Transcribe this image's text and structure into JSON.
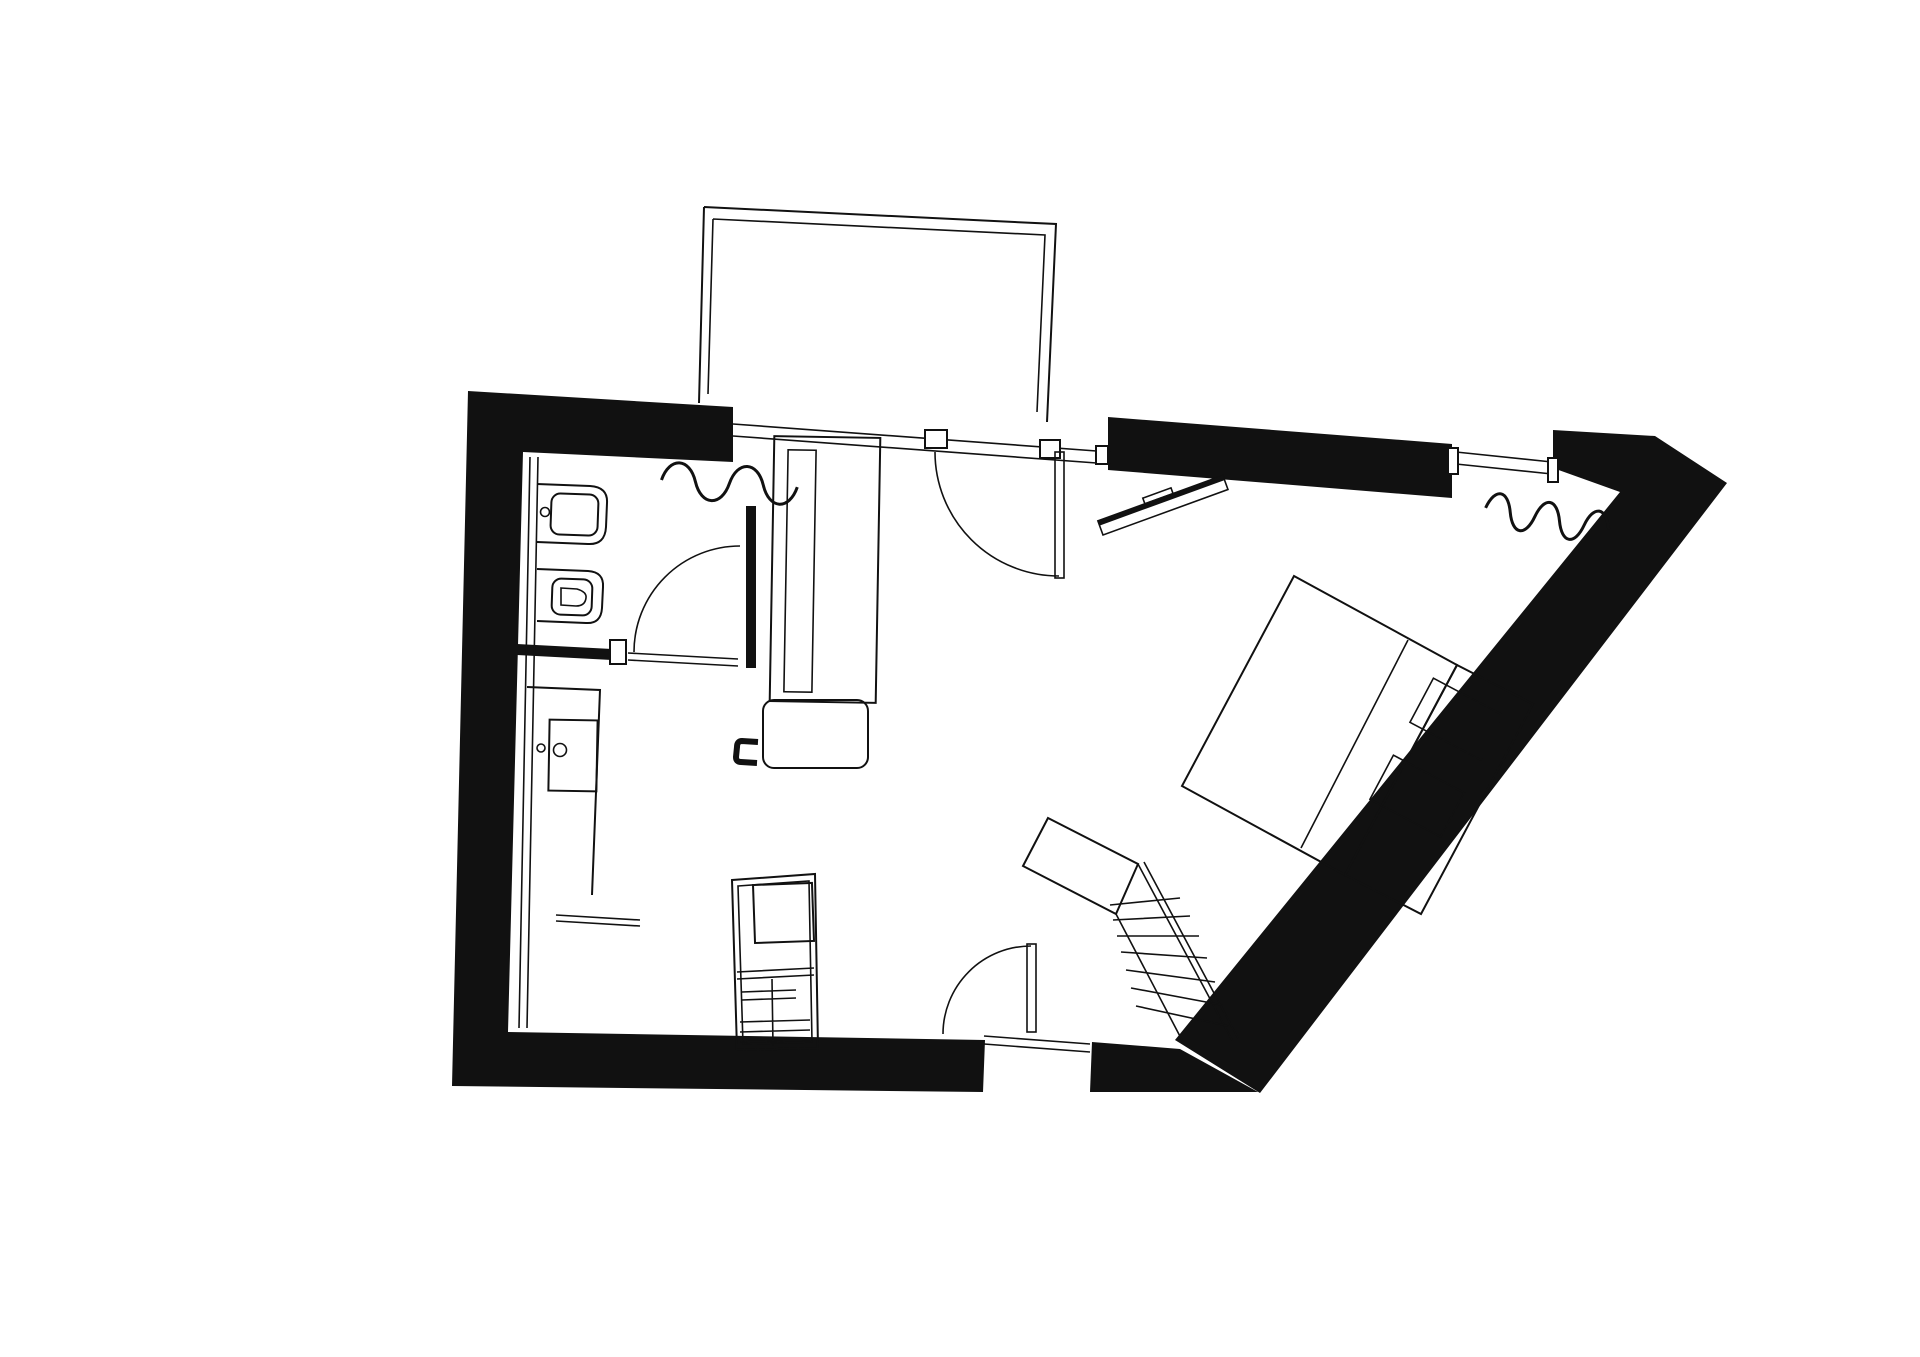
{
  "document": {
    "title": "apartment-floor-plan",
    "description_label": "Black and white architectural floor plan of a small studio apartment with balcony, bathroom, kitchenette, wardrobe, bed and a winding staircase"
  },
  "colors": {
    "ink": "#111111",
    "paper": "#ffffff"
  },
  "legend": {
    "rooms": [
      {
        "name": "balcony"
      },
      {
        "name": "bathroom"
      },
      {
        "name": "kitchenette"
      },
      {
        "name": "living-sleeping-area"
      },
      {
        "name": "entry-hall"
      }
    ],
    "fixtures": [
      {
        "name": "washbasin"
      },
      {
        "name": "toilet"
      },
      {
        "name": "kitchen-sink"
      },
      {
        "name": "wardrobe"
      },
      {
        "name": "desk"
      },
      {
        "name": "chair"
      },
      {
        "name": "wall-shelf"
      },
      {
        "name": "radiator-left"
      },
      {
        "name": "radiator-right"
      },
      {
        "name": "double-bed"
      },
      {
        "name": "pillows"
      },
      {
        "name": "appliance-column"
      },
      {
        "name": "winder-staircase"
      },
      {
        "name": "balcony-door"
      },
      {
        "name": "bathroom-door"
      },
      {
        "name": "entrance-door"
      },
      {
        "name": "window"
      }
    ]
  }
}
